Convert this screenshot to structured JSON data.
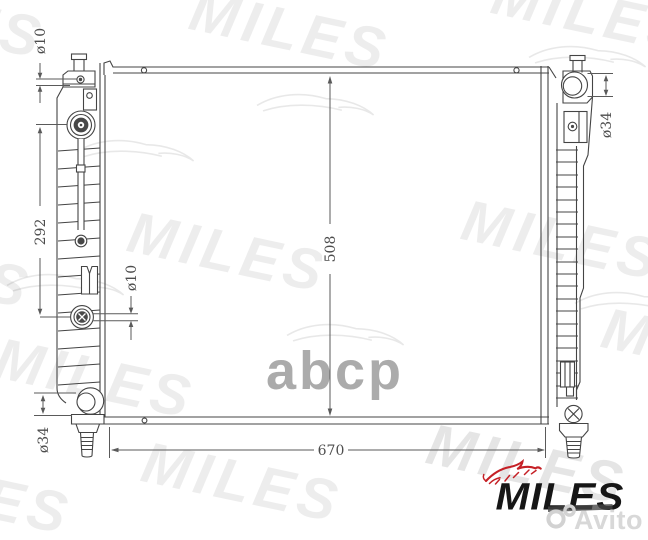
{
  "drawing": {
    "line_color": "#444444",
    "dim_color": "#4d4d4d",
    "dim_labels": {
      "top_left_hole": "ø10",
      "left_span": "292",
      "left_port": "ø10",
      "bottom_left_pipe": "ø34",
      "top_right_pipe": "ø34",
      "core_height": "508",
      "core_width": "670"
    }
  },
  "branding": {
    "logo_text": "MILES",
    "logo_color": "#161616",
    "accent_color": "#c52026"
  },
  "watermarks": {
    "brand": "MILES",
    "abcp": "abcp",
    "avito": "Avito"
  }
}
